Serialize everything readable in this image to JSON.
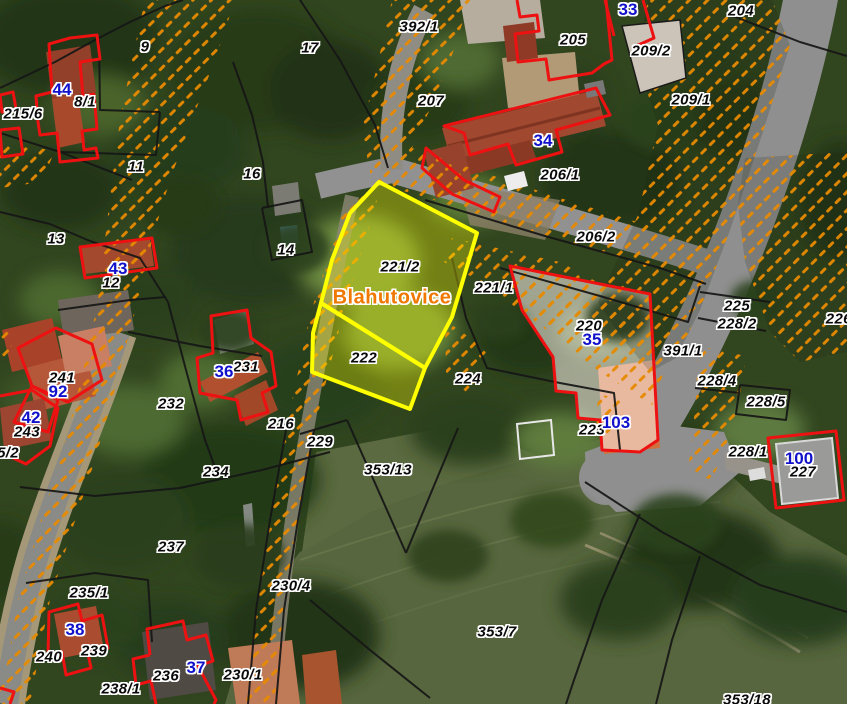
{
  "map": {
    "title": "Cadastral map over aerial photo",
    "village_label": {
      "text": "Blahutovice",
      "x": 392,
      "y": 298
    },
    "highlighted_parcels": [
      "221/2",
      "222"
    ],
    "colors": {
      "parcel_label": "#0a0a0a",
      "building_label": "#1111cc",
      "village_label": "#f07800",
      "highlight_border": "#ffff00",
      "highlight_fill": "rgba(255,255,0,0.32)",
      "building_outline": "#ee1111",
      "parcel_line": "#161616",
      "hatch": "#e78a00"
    },
    "parcel_labels": [
      {
        "text": "9",
        "x": 145,
        "y": 47
      },
      {
        "text": "17",
        "x": 310,
        "y": 48
      },
      {
        "text": "392/1",
        "x": 419,
        "y": 27
      },
      {
        "text": "205",
        "x": 573,
        "y": 40
      },
      {
        "text": "209/2",
        "x": 651,
        "y": 51
      },
      {
        "text": "204",
        "x": 741,
        "y": 11
      },
      {
        "text": "207",
        "x": 431,
        "y": 101
      },
      {
        "text": "209/1",
        "x": 691,
        "y": 100
      },
      {
        "text": "8/1",
        "x": 85,
        "y": 102
      },
      {
        "text": "215/6",
        "x": 23,
        "y": 114
      },
      {
        "text": "11",
        "x": 136,
        "y": 167
      },
      {
        "text": "16",
        "x": 252,
        "y": 174
      },
      {
        "text": "206/1",
        "x": 560,
        "y": 175
      },
      {
        "text": "206/2",
        "x": 596,
        "y": 237
      },
      {
        "text": "13",
        "x": 56,
        "y": 239
      },
      {
        "text": "12",
        "x": 111,
        "y": 283
      },
      {
        "text": "14",
        "x": 286,
        "y": 250
      },
      {
        "text": "221/2",
        "x": 400,
        "y": 267
      },
      {
        "text": "221/1",
        "x": 494,
        "y": 288
      },
      {
        "text": "220",
        "x": 589,
        "y": 326
      },
      {
        "text": "225",
        "x": 737,
        "y": 306
      },
      {
        "text": "228/2",
        "x": 737,
        "y": 324
      },
      {
        "text": "226/",
        "x": 841,
        "y": 319
      },
      {
        "text": "391/1",
        "x": 683,
        "y": 351
      },
      {
        "text": "241",
        "x": 62,
        "y": 378
      },
      {
        "text": "231",
        "x": 246,
        "y": 367
      },
      {
        "text": "232",
        "x": 171,
        "y": 404
      },
      {
        "text": "243",
        "x": 27,
        "y": 432
      },
      {
        "text": "222",
        "x": 364,
        "y": 358
      },
      {
        "text": "224",
        "x": 468,
        "y": 379
      },
      {
        "text": "228/4",
        "x": 717,
        "y": 381
      },
      {
        "text": "228/5",
        "x": 766,
        "y": 402
      },
      {
        "text": "223",
        "x": 592,
        "y": 430
      },
      {
        "text": "216",
        "x": 281,
        "y": 424
      },
      {
        "text": "229",
        "x": 320,
        "y": 442
      },
      {
        "text": "228/1",
        "x": 748,
        "y": 452
      },
      {
        "text": "227",
        "x": 803,
        "y": 472
      },
      {
        "text": "5/2",
        "x": 8,
        "y": 453
      },
      {
        "text": "234",
        "x": 216,
        "y": 472
      },
      {
        "text": "237",
        "x": 171,
        "y": 547
      },
      {
        "text": "353/13",
        "x": 388,
        "y": 470
      },
      {
        "text": "230/4",
        "x": 291,
        "y": 586
      },
      {
        "text": "235/1",
        "x": 89,
        "y": 593
      },
      {
        "text": "240",
        "x": 49,
        "y": 657
      },
      {
        "text": "239",
        "x": 94,
        "y": 651
      },
      {
        "text": "236",
        "x": 166,
        "y": 676
      },
      {
        "text": "238/1",
        "x": 121,
        "y": 689
      },
      {
        "text": "230/1",
        "x": 243,
        "y": 675
      },
      {
        "text": "353/7",
        "x": 497,
        "y": 632
      },
      {
        "text": "353/18",
        "x": 747,
        "y": 700
      }
    ],
    "building_labels": [
      {
        "text": "44",
        "x": 62,
        "y": 90
      },
      {
        "text": "33",
        "x": 628,
        "y": 10
      },
      {
        "text": "34",
        "x": 543,
        "y": 141
      },
      {
        "text": "43",
        "x": 118,
        "y": 269
      },
      {
        "text": "36",
        "x": 224,
        "y": 372
      },
      {
        "text": "92",
        "x": 58,
        "y": 392
      },
      {
        "text": "42",
        "x": 31,
        "y": 418
      },
      {
        "text": "35",
        "x": 592,
        "y": 340
      },
      {
        "text": "103",
        "x": 616,
        "y": 423
      },
      {
        "text": "100",
        "x": 799,
        "y": 459
      },
      {
        "text": "38",
        "x": 75,
        "y": 630
      },
      {
        "text": "37",
        "x": 196,
        "y": 668
      }
    ]
  }
}
